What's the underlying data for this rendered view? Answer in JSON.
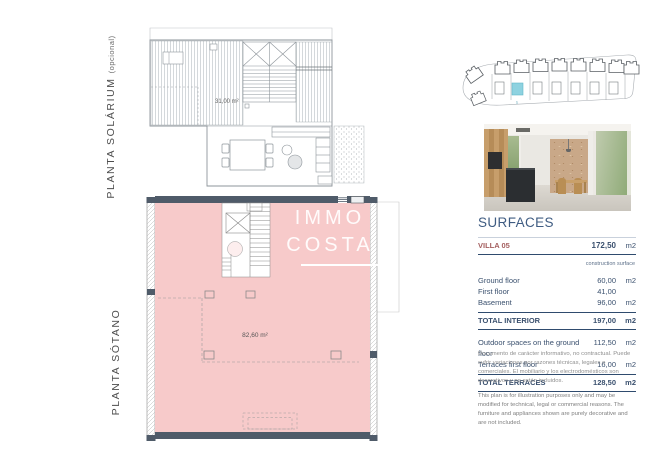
{
  "labels": {
    "solarium_main": "PLANTA SOLÁRIUM",
    "solarium_suffix": "(opcional)",
    "sotano": "PLANTA SÓTANO"
  },
  "plans": {
    "solarium_area": "31,00 m²",
    "basement_area": "82,60 m²"
  },
  "watermark": {
    "line1": "IMMO",
    "line2": "COSTA"
  },
  "site": {
    "highlight_label": "5"
  },
  "surfaces": {
    "title": "SURFACES",
    "villa": {
      "label": "VILLA 05",
      "value": "172,50",
      "unit": "m2"
    },
    "subheader": "construction surface",
    "rows": [
      {
        "label": "Ground floor",
        "value": "60,00",
        "unit": "m2"
      },
      {
        "label": "First floor",
        "value": "41,00",
        "unit": ""
      },
      {
        "label": "Basement",
        "value": "96,00",
        "unit": "m2"
      }
    ],
    "total_interior": {
      "label": "TOTAL INTERIOR",
      "value": "197,00",
      "unit": "m2"
    },
    "outdoor_rows": [
      {
        "label": "Outdoor spaces on the ground floor",
        "value": "112,50",
        "unit": "m2"
      },
      {
        "label": "Terraces first floor",
        "value": "16,00",
        "unit": "m2"
      }
    ],
    "total_terraces": {
      "label": "TOTAL TERRACES",
      "value": "128,50",
      "unit": "m2"
    }
  },
  "disclaimer": {
    "es": "Documento de carácter informativo, no contractual. Puede sufrir variaciones por razones técnicas, legales o comerciales. El mobiliario y los electrodomésticos son decorativos y no están incluidos.",
    "en": "This plan is for illustration purposes only and may be modified for technical, legal or commercial reasons. The furniture and appliances shown are purely decorative and are not included."
  },
  "colors": {
    "pink": "#f7caca",
    "navy_wall": "#4f5b69",
    "accent_red": "#a45f5f",
    "table_navy": "#3f5c82",
    "highlight_cyan": "#8ed2e0"
  }
}
